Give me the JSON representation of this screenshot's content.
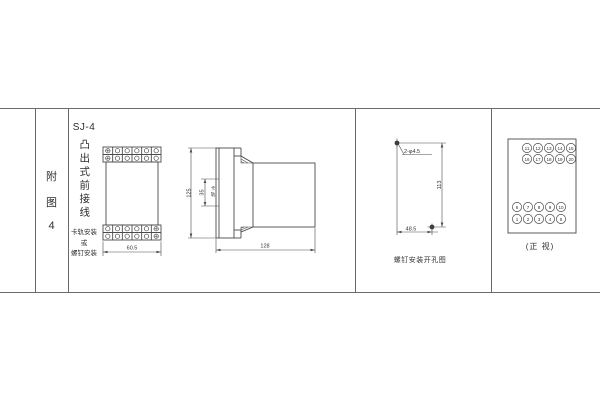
{
  "figure_label": {
    "chars": [
      "附",
      "图",
      "4"
    ]
  },
  "title_block": {
    "model": "SJ-4",
    "title_vertical": "凸出式前接线",
    "note_lines": [
      "卡轨安装",
      "或",
      "螺钉安装"
    ]
  },
  "drawings": {
    "front_terminal_view": {
      "width_dim": "60.5"
    },
    "side_view": {
      "height_dim": "125",
      "rail_dim": "35",
      "rail_label": "卡轨",
      "depth_dim": "128"
    },
    "drill_plan": {
      "holes_label": "2-φ4.5",
      "height_dim": "113",
      "width_dim": "48.5",
      "caption": "螺钉安装开孔图"
    },
    "front_view": {
      "caption": "(正 视)",
      "top_row1": [
        "11",
        "12",
        "13",
        "14",
        "15"
      ],
      "top_row2": [
        "16",
        "17",
        "18",
        "19",
        "20"
      ],
      "bottom_row1": [
        "6",
        "7",
        "8",
        "9",
        "10"
      ],
      "bottom_row2": [
        "1",
        "2",
        "3",
        "4",
        "5"
      ]
    }
  },
  "colors": {
    "line": "#4a4a4a",
    "text": "#3c3c3c"
  }
}
